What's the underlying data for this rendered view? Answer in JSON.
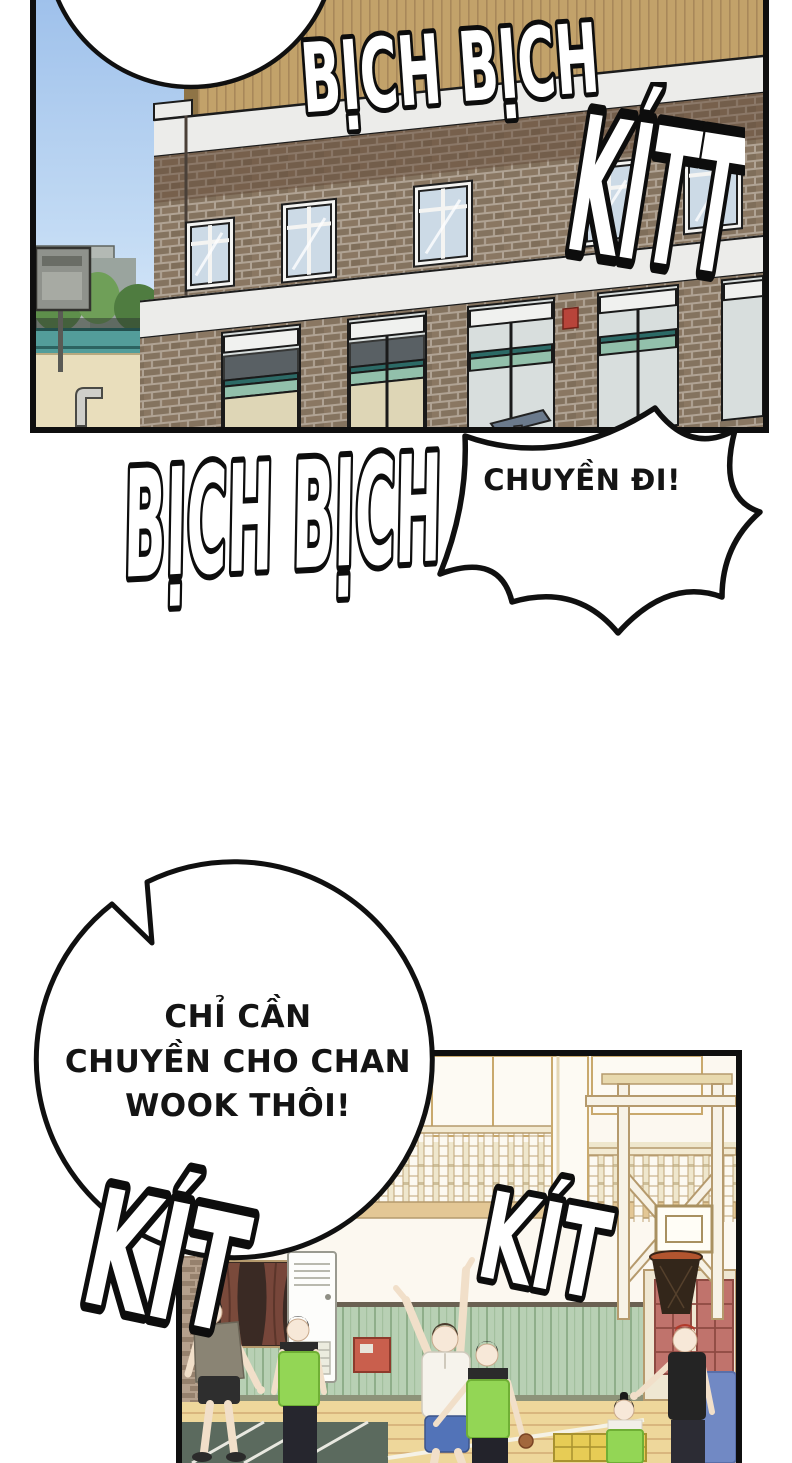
{
  "comic": {
    "panel_school": {
      "sfx_top": "BỊCH BỊCH",
      "sfx_right": "KÍTT"
    },
    "sfx_between": "BỊCH BỊCH",
    "burst_bubble": {
      "text": "CHUYỀN ĐI!"
    },
    "round_bubble": {
      "line1": "CHỈ CẦN",
      "line2": "CHUYỀN CHO CHAN",
      "line3": "WOOK THÔI!"
    },
    "panel_gym": {
      "sfx_left": "KÍT",
      "sfx_right": "KÍT"
    },
    "colors": {
      "ink": "#0f0f0f",
      "sky_top": "#9fc1eb",
      "sky_bottom": "#dcebf8",
      "roof_tan": "#c2a26a",
      "brick": "#84735f",
      "brick_dark": "#5f4433",
      "trim_white": "#ececea",
      "window_glass": "#ccdae6",
      "fence_teal": "#539d9a",
      "sand": "#e9debc",
      "gym_wall": "#fcf8f0",
      "gym_trim": "#c9a96d",
      "wainscot_green": "#b8d0b4",
      "floor_wood": "#eed79b",
      "mat_dark_green": "#5b6a5e",
      "mat_yellow": "#e7cc55",
      "mat_blue": "#7189c4",
      "pinnie_green": "#93d655",
      "shorts_blue": "#5273b8",
      "hair_red": "#b23a2a",
      "cabinet_red": "#c95f4d",
      "net_brown": "#33261a",
      "skin": "#f7e8d8"
    }
  }
}
